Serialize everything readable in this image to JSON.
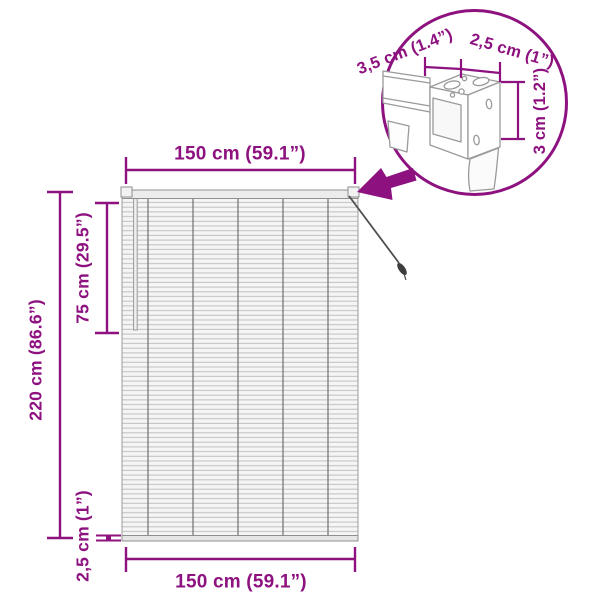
{
  "diagram": {
    "title_semantics": "window-blind-dimension-diagram",
    "accent_color": "#8D117F",
    "line_gray": "#9A9A9A",
    "slat_fill": "#F5F5F5",
    "labels": {
      "width_top": "150 cm (59.1”)",
      "width_bottom": "150 cm (59.1”)",
      "height_total": "220 cm (86.6”)",
      "cord_length": "75 cm (29.5”)",
      "bottom_rail_height": "2,5 cm (1”)",
      "bracket_depth": "3,5 cm (1.4”)",
      "bracket_width": "2,5 cm (1”)",
      "bracket_height": "3 cm (1.2”)"
    },
    "icons": {
      "detail_arrow": "arrow pointing to top-right bracket",
      "detail_circle": "magnified bracket detail circle"
    }
  }
}
